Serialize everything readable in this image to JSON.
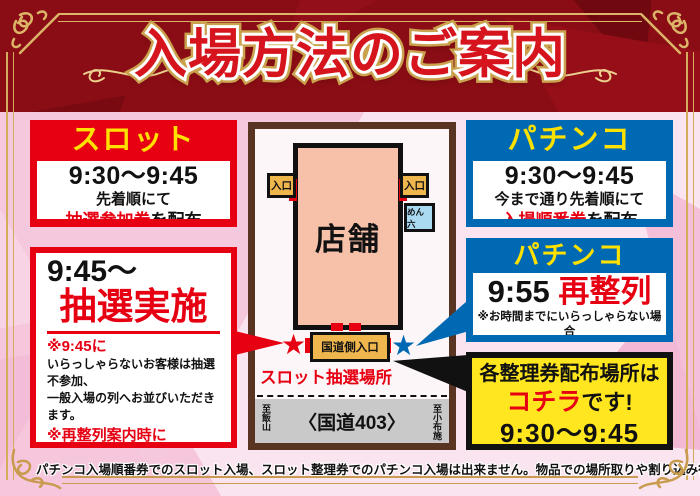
{
  "header": {
    "title": "入場方法のご案内"
  },
  "slot_box": {
    "title": "スロット",
    "time": "9:30〜9:45",
    "line1": "先着順にて",
    "ticket": "抽選参加券",
    "ticket_suffix": "を配布"
  },
  "lottery_box": {
    "time": "9:45〜",
    "title": "抽選実施",
    "note1_head": "※9:45に",
    "note1_line1": "いらっしゃらないお客様は抽選不参加、",
    "note1_line2": "一般入場の列へお並びいただきます。",
    "note2_head": "※再整列案内時に",
    "note2_line1": "いらっしゃらないお客様は最後尾へ",
    "note2_line2": "ご案内させていただきます。"
  },
  "pachinko_box": {
    "title": "パチンコ",
    "time": "9:30〜9:45",
    "line1": "今まで通り先着順にて",
    "ticket": "入場順番券",
    "ticket_suffix": "を配布"
  },
  "relineup_box": {
    "title": "パチンコ",
    "time": "9:55 ",
    "highlight": "再整列",
    "note_line1": "※お時間までにいらっしゃらない場合",
    "note_line2": "最後尾にさせて頂きます。"
  },
  "location_box": {
    "line1": "各整理券配布場所は",
    "highlight": "コチラ",
    "line2_suffix": "です!",
    "time": "9:30〜9:45"
  },
  "map": {
    "store_label": "店舗",
    "entrance_left_label": "入口",
    "entrance_right_label": "入口",
    "menroku_label": "めん六",
    "road_entrance_label": "国道側入口",
    "slot_lottery_label": "スロット抽選場所",
    "road_label": "〈国道403〉",
    "direction_left": "至飯山",
    "direction_right": "至小布施"
  },
  "footer": {
    "disclaimer": "パチンコ入場順番券でのスロット入場、スロット整理券でのパチンコ入場は出来ません。物品での場所取りや割り込み行為はご遠慮ください。"
  },
  "icons": {
    "star": "★"
  },
  "colors": {
    "accent_red": "#e60012",
    "accent_blue": "#0069b4",
    "accent_yellow": "#ffe100",
    "location_yellow": "#ffe61e",
    "header_dark_red": "#8a0d15",
    "gold": "#d3ac5e",
    "store_fill": "#f6c1a8",
    "entrance_fill": "#efb64e",
    "menroku_fill": "#aad9f2",
    "road_gray": "#c9c9ca",
    "map_border_brown": "#5a3423",
    "background_pink": "#fae4ef"
  }
}
